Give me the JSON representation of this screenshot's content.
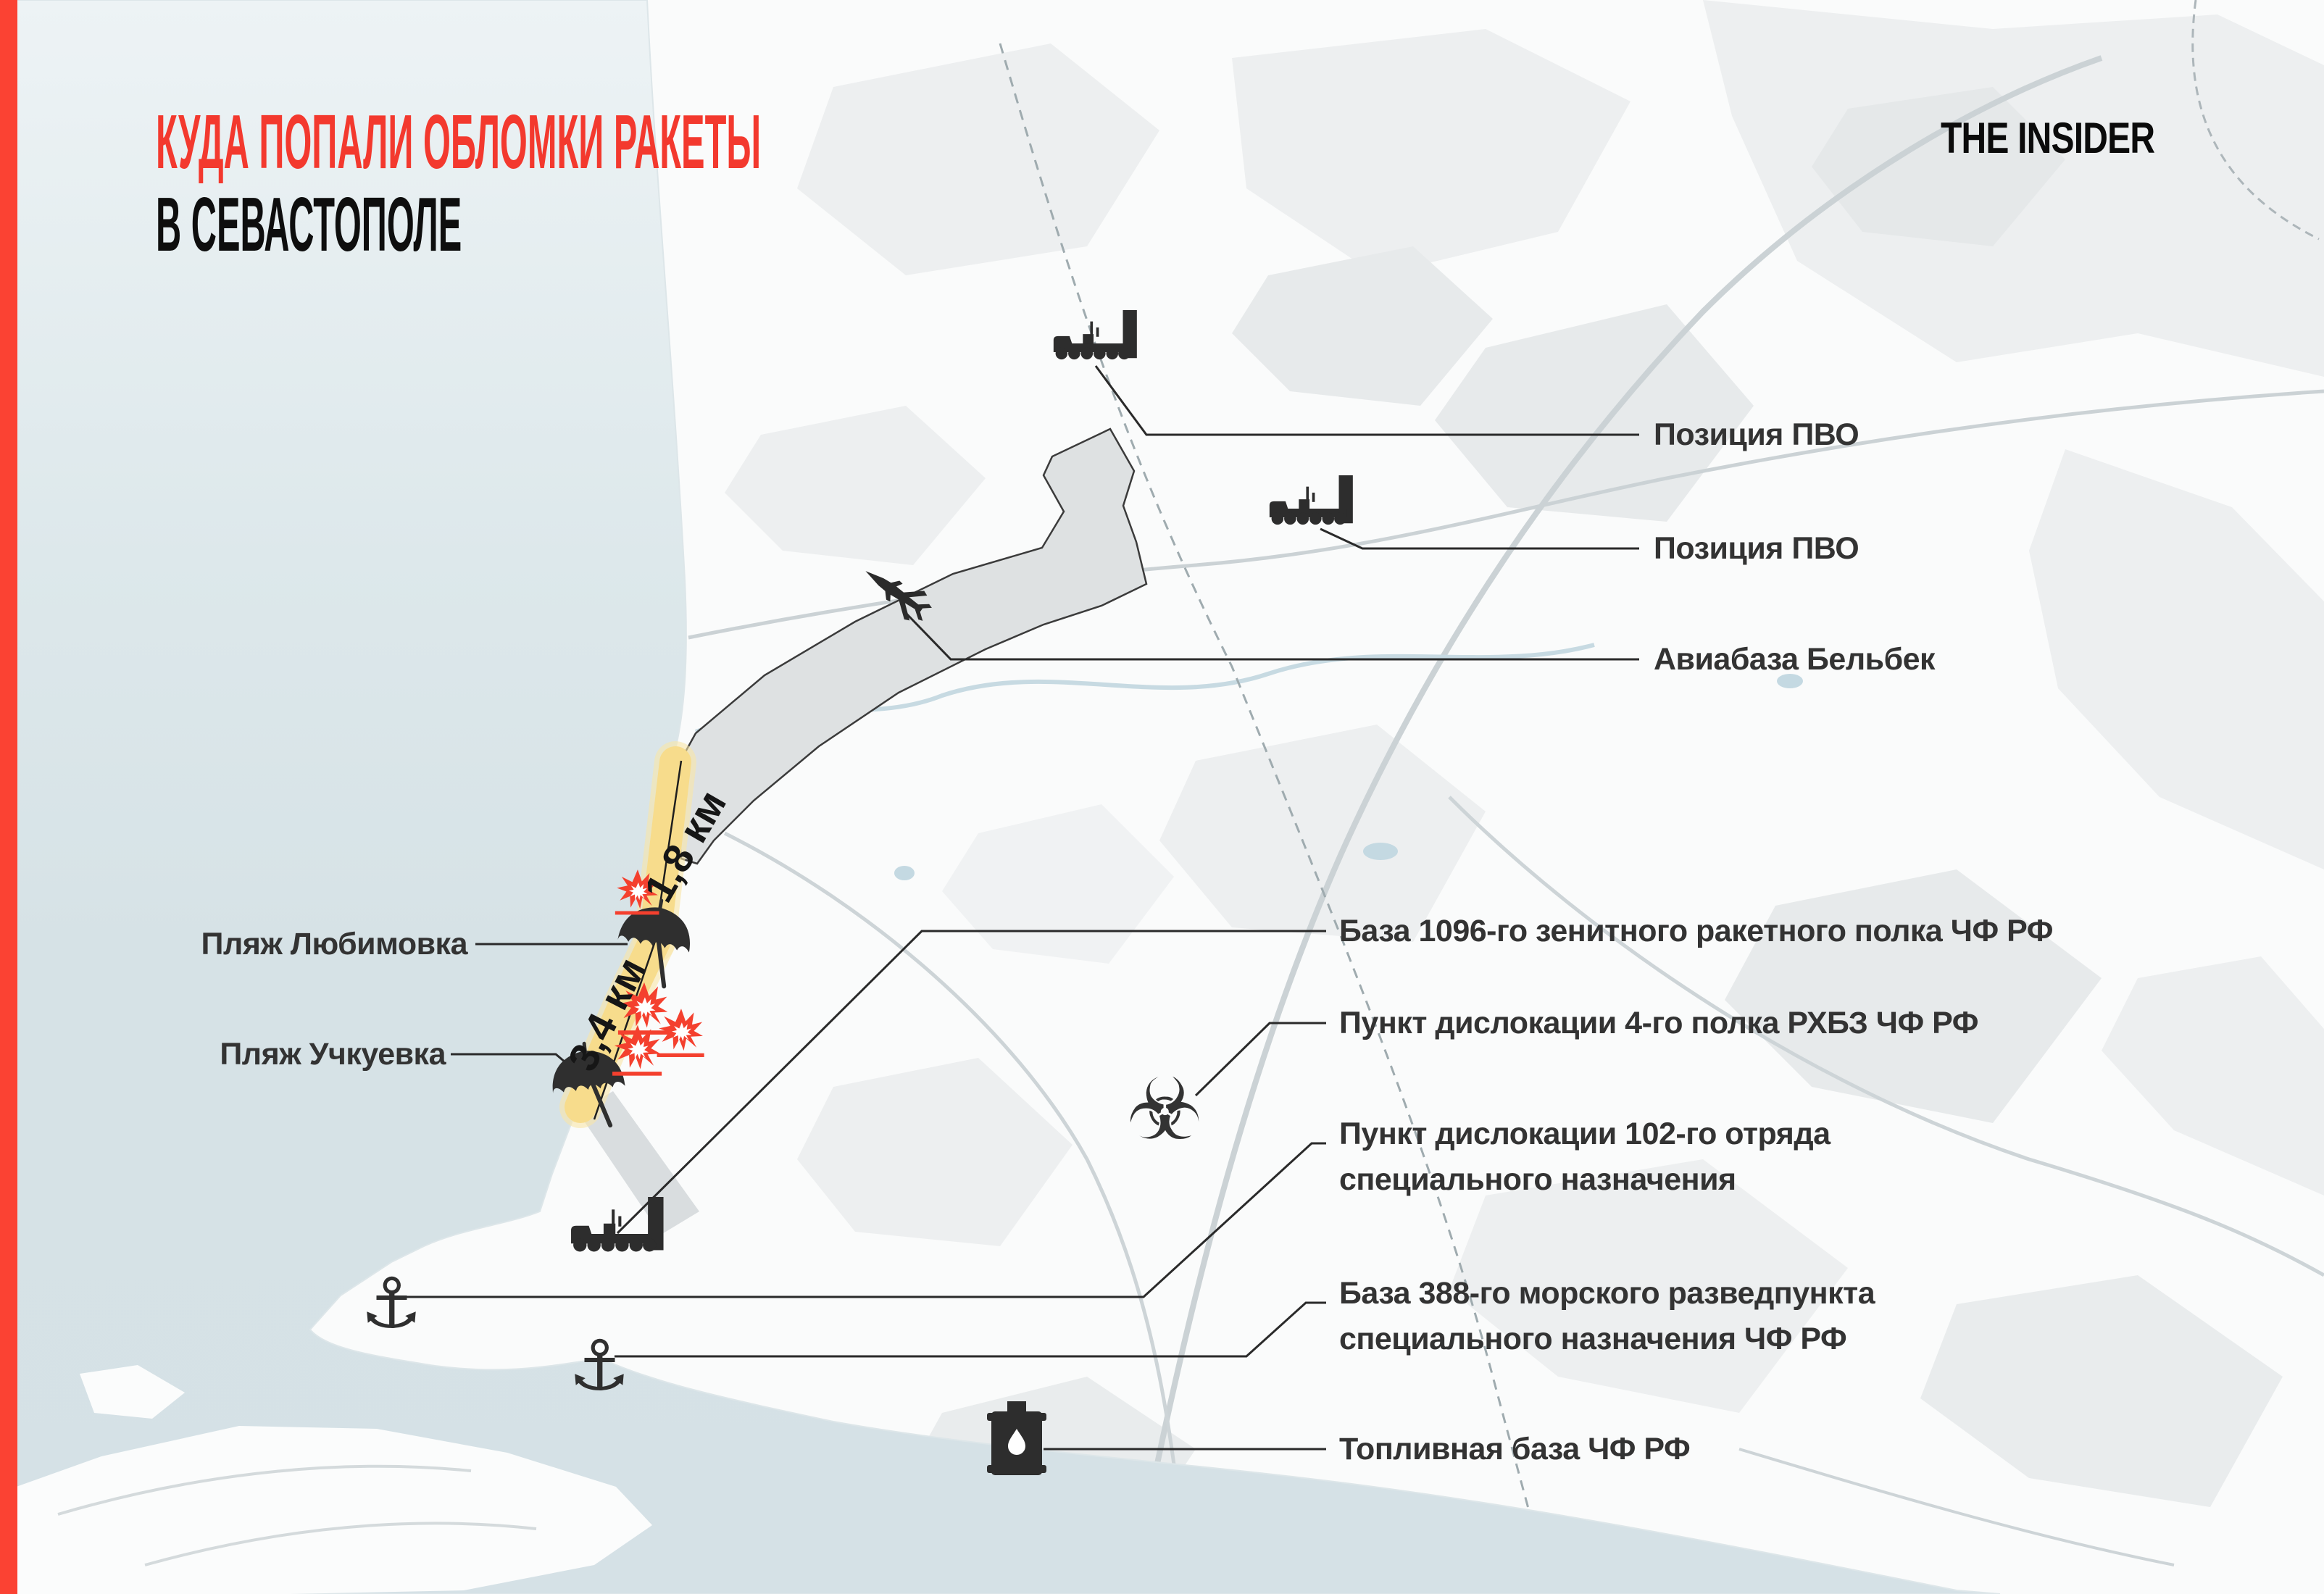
{
  "brand": {
    "logo": "THE INSIDER"
  },
  "title": {
    "line1": "КУДА ПОПАЛИ ОБЛОМКИ РАКЕТЫ",
    "line2": "В СЕВАСТОПОЛЕ"
  },
  "colors": {
    "accent_red": "#F3392E",
    "explosion_red": "#F4402E",
    "beach_yellow": "#F7DC8C",
    "sea_blue": "#D7E3E7",
    "airfield_grey": "#DEE1E2",
    "icon_dark": "#2D2D2D",
    "label_grey": "#333333"
  },
  "map": {
    "distance_labels": [
      {
        "text": "1,8 км"
      },
      {
        "text": "3,4 км"
      }
    ],
    "beach_labels": [
      {
        "text": "Пляж Любимовка"
      },
      {
        "text": "Пляж Учкуевка"
      }
    ],
    "callouts": [
      {
        "id": "pvo-1",
        "icon": "sam-launcher",
        "lines": [
          "Позиция ПВО"
        ]
      },
      {
        "id": "pvo-2",
        "icon": "sam-launcher",
        "lines": [
          "Позиция ПВО"
        ]
      },
      {
        "id": "belbek",
        "icon": "fighter-jet",
        "lines": [
          "Авиабаза Бельбек"
        ]
      },
      {
        "id": "base-1096",
        "icon": "sam-launcher",
        "lines": [
          "База 1096-го зенитного ракетного полка ЧФ РФ"
        ]
      },
      {
        "id": "rhbz-4",
        "icon": "biohazard",
        "lines": [
          "Пункт дислокации 4-го полка РХБЗ ЧФ РФ"
        ]
      },
      {
        "id": "unit-102",
        "icon": "anchor",
        "lines": [
          "Пункт дислокации 102-го отряда",
          "специального назначения"
        ]
      },
      {
        "id": "base-388",
        "icon": "anchor",
        "lines": [
          "База 388-го морского разведпункта",
          "специального назначения ЧФ РФ"
        ]
      },
      {
        "id": "fuel-base",
        "icon": "fuel-barrel",
        "lines": [
          "Топливная база ЧФ РФ"
        ]
      }
    ],
    "icons": {
      "biohazard_glyph": "☣",
      "anchor_glyph": "⚓"
    }
  }
}
